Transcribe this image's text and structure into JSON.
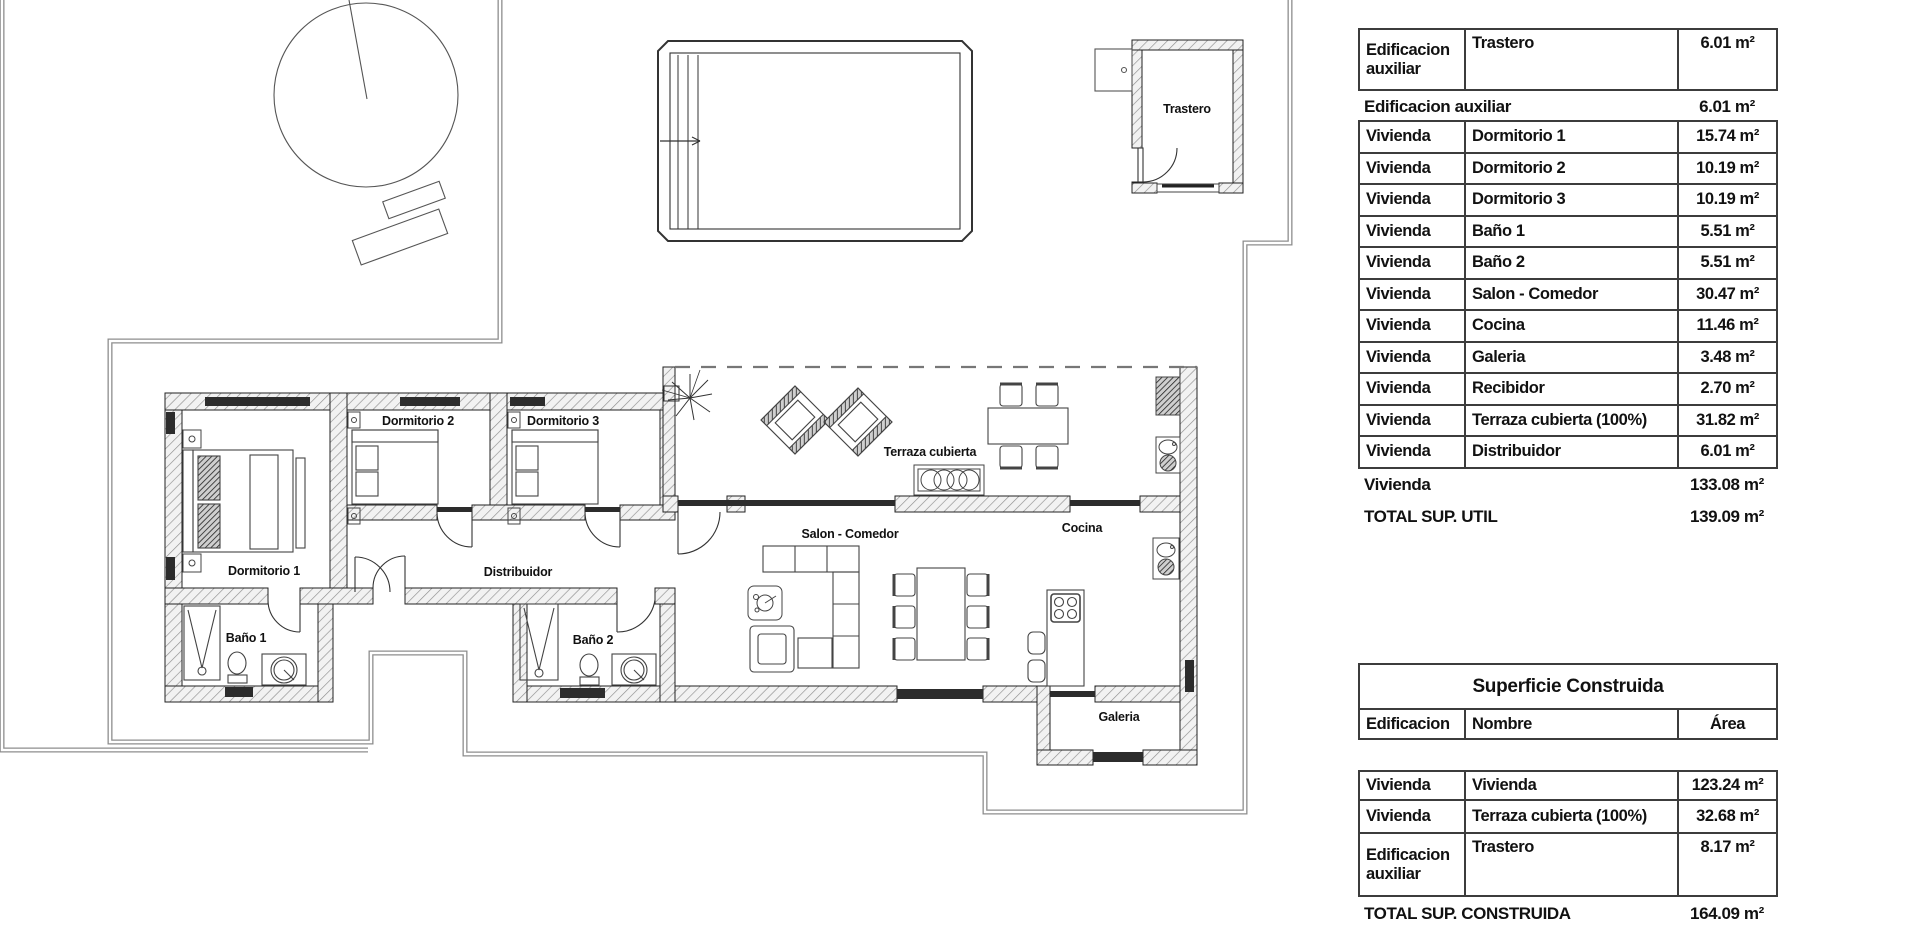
{
  "plan": {
    "labels": {
      "dormitorio1": "Dormitorio 1",
      "dormitorio2": "Dormitorio 2",
      "dormitorio3": "Dormitorio 3",
      "bano1": "Baño 1",
      "bano2": "Baño 2",
      "distribuidor": "Distribuidor",
      "salon_comedor": "Salon - Comedor",
      "cocina": "Cocina",
      "galeria": "Galeria",
      "terraza": "Terraza cubierta",
      "trastero": "Trastero"
    }
  },
  "tables": {
    "superficie_util": {
      "header_row": {
        "edificacion": "Edificacion auxiliar",
        "nombre": "Trastero",
        "area": "6.01 m²"
      },
      "subtotal_aux": {
        "label": "Edificacion auxiliar",
        "value": "6.01 m²"
      },
      "rows": [
        {
          "edificacion": "Vivienda",
          "nombre": "Dormitorio 1",
          "area": "15.74 m²"
        },
        {
          "edificacion": "Vivienda",
          "nombre": "Dormitorio 2",
          "area": "10.19 m²"
        },
        {
          "edificacion": "Vivienda",
          "nombre": "Dormitorio 3",
          "area": "10.19 m²"
        },
        {
          "edificacion": "Vivienda",
          "nombre": "Baño 1",
          "area": "5.51 m²"
        },
        {
          "edificacion": "Vivienda",
          "nombre": "Baño 2",
          "area": "5.51 m²"
        },
        {
          "edificacion": "Vivienda",
          "nombre": "Salon - Comedor",
          "area": "30.47 m²"
        },
        {
          "edificacion": "Vivienda",
          "nombre": "Cocina",
          "area": "11.46 m²"
        },
        {
          "edificacion": "Vivienda",
          "nombre": "Galeria",
          "area": "3.48 m²"
        },
        {
          "edificacion": "Vivienda",
          "nombre": "Recibidor",
          "area": "2.70 m²"
        },
        {
          "edificacion": "Vivienda",
          "nombre": "Terraza cubierta (100%)",
          "area": "31.82 m²"
        },
        {
          "edificacion": "Vivienda",
          "nombre": "Distribuidor",
          "area": "6.01 m²"
        }
      ],
      "subtotal_vivienda": {
        "label": "Vivienda",
        "value": "133.08 m²"
      },
      "total": {
        "label": "TOTAL SUP. UTIL",
        "value": "139.09 m²"
      }
    },
    "superficie_construida": {
      "title": "Superficie Construida",
      "columns": {
        "edificacion": "Edificacion",
        "nombre": "Nombre",
        "area": "Área"
      },
      "rows": [
        {
          "edificacion": "Vivienda",
          "nombre": "Vivienda",
          "area": "123.24 m²"
        },
        {
          "edificacion": "Vivienda",
          "nombre": "Terraza cubierta (100%)",
          "area": "32.68 m²"
        },
        {
          "edificacion": "Edificacion auxiliar",
          "nombre": "Trastero",
          "area": "8.17 m²"
        }
      ],
      "total": {
        "label": "TOTAL SUP. CONSTRUIDA",
        "value": "164.09 m²"
      }
    }
  }
}
